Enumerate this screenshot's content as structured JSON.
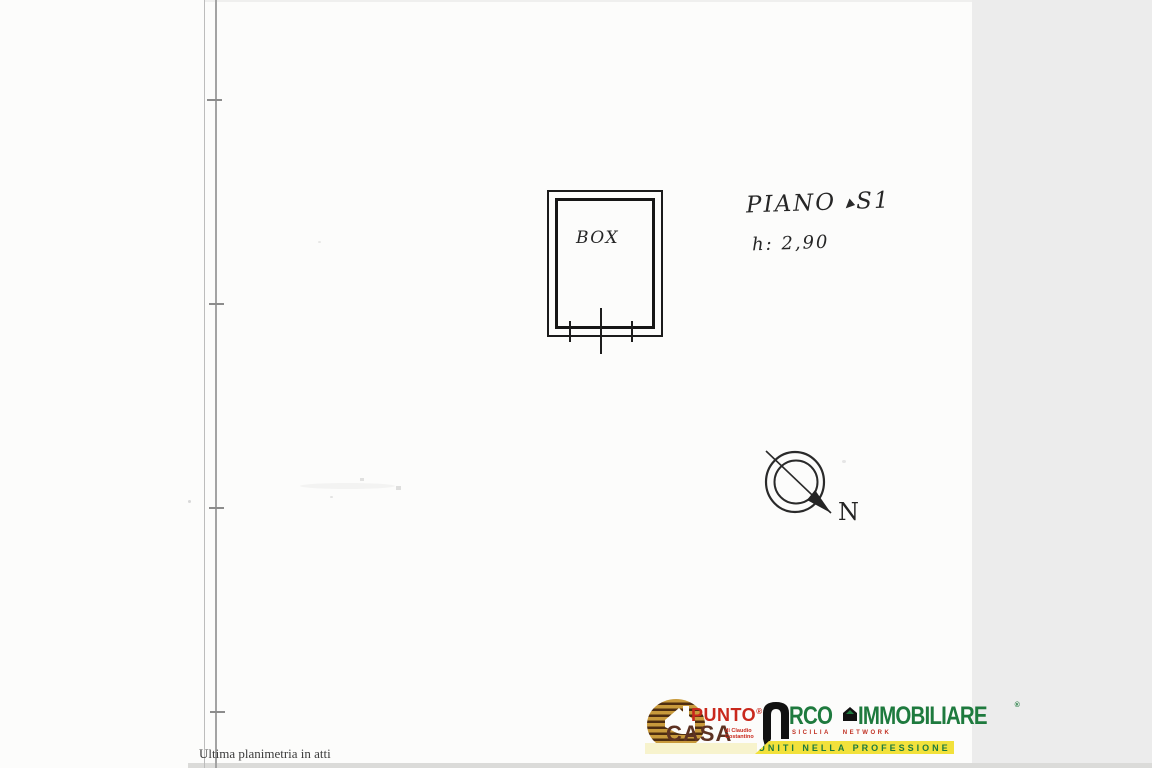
{
  "document": {
    "footer_note": "Ultima planimetria in atti"
  },
  "plan": {
    "room_label": "BOX",
    "floor_word": "PIANO",
    "floor_value": "S1",
    "height_note": "h: 2,90",
    "compass_north": "N"
  },
  "branding": {
    "punto_casa": {
      "word_top": "PUNTO",
      "registered": "®",
      "word_bottom": "CASA",
      "byline_line1": "di Claudio",
      "byline_line2": "Costantino"
    },
    "arco": {
      "brand_rest": "RCO",
      "brand_second": "IMMOBILIARE",
      "registered": "®",
      "network_text": "SICILIA NETWORK",
      "banner_text": "UNITI NELLA PROFESSIONE"
    }
  },
  "colors": {
    "ink": "#1b1b1b",
    "punto_red": "#c9281c",
    "casa_brown": "#5d3222",
    "emblem_gold": "#c89a3c",
    "emblem_dark_brown": "#4e2d10",
    "arco_green": "#1e7a3e",
    "network_red": "#c03122",
    "banner_yellow": "#f2e13b",
    "banner_pale_yellow": "#f7f3cd",
    "scanner_gray": "#ececec"
  }
}
